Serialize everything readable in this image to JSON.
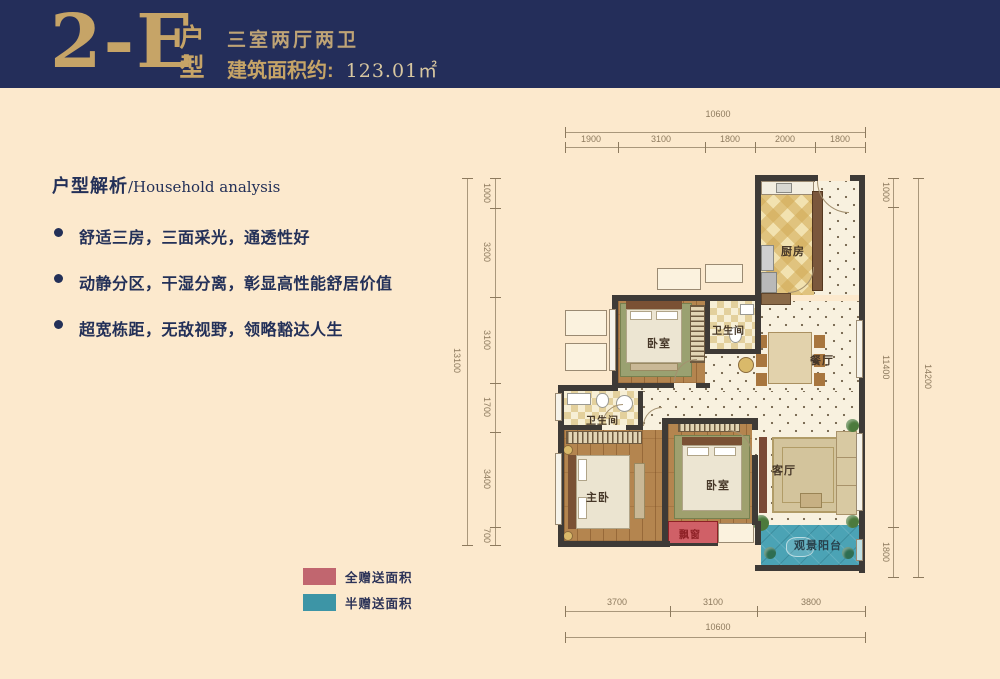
{
  "header": {
    "unit_code": "2-E",
    "unit_suffix": "户型",
    "layout_desc": "三室两厅两卫",
    "area_label": "建筑面积约:",
    "area_value": "123.01㎡"
  },
  "analysis": {
    "title_zh": "户型解析",
    "title_en": "/Household analysis",
    "bullets": [
      "舒适三房，三面采光，通透性好",
      "动静分区，干湿分离，彰显高性能舒居价值",
      "超宽栋距，无敌视野，领略豁达人生"
    ]
  },
  "legend": {
    "full_gift": {
      "label": "全赠送面积",
      "color": "#c1666f"
    },
    "half_gift": {
      "label": "半赠送面积",
      "color": "#3d95a6"
    }
  },
  "floorplan": {
    "rooms": {
      "kitchen": "厨房",
      "bath_upper": "卫生间",
      "dining": "餐厅",
      "bedroom_upper": "卧室",
      "bath_lower": "卫生间",
      "master": "主卧",
      "bedroom_mid": "卧室",
      "living": "客厅",
      "balcony": "观景阳台",
      "bay_window": "飘窗"
    },
    "dims": {
      "top_total": "10600",
      "top_segments": [
        "1900",
        "3100",
        "1800",
        "2000",
        "1800"
      ],
      "left_total": "13100",
      "left_segments": [
        "1000",
        "3200",
        "3100",
        "1700",
        "3400",
        "700"
      ],
      "right_total": "14200",
      "right_segments": [
        "1000",
        "11400",
        "1800"
      ],
      "bottom_total": "10600",
      "bottom_segments": [
        "3700",
        "3100",
        "3800"
      ]
    }
  },
  "colors": {
    "banner_navy": "#242e5a",
    "gold": "#c6a467",
    "background_cream": "#fce9cd",
    "full_gift_pink": "#c1666f",
    "half_gift_teal": "#3d95a6",
    "bay_window_red": "#d06067",
    "balcony_teal": "#4ba3b5"
  }
}
